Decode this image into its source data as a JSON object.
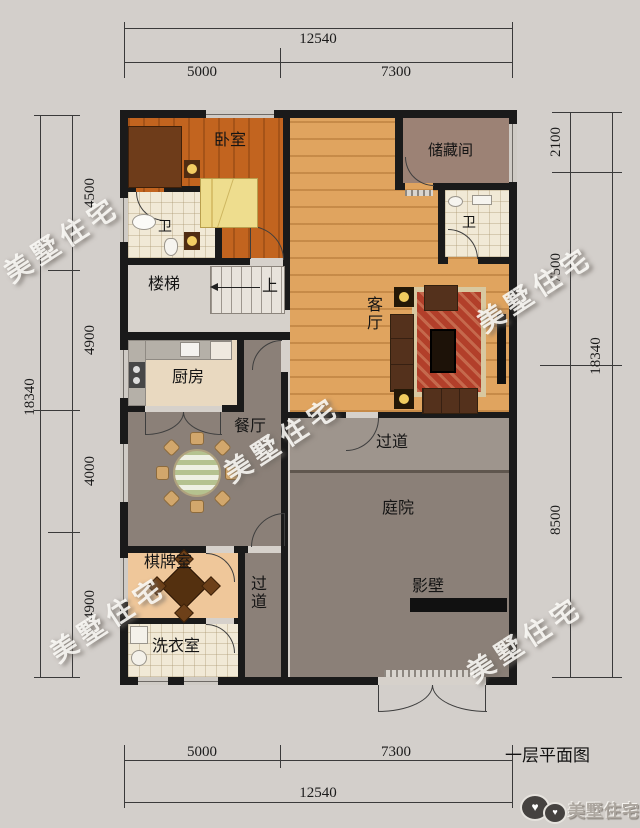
{
  "plan": {
    "title": "一层平面图",
    "watermark": "美墅住宅",
    "logo_text": "美墅住宅",
    "rooms": {
      "bedroom": "卧室",
      "storage": "储藏间",
      "bath1": "卫",
      "bath2": "卫",
      "stairs": "楼梯",
      "stairs_up": "上",
      "living": "客厅",
      "kitchen": "厨房",
      "dining": "餐厅",
      "corridor_v": "过道",
      "corridor_h": "过道",
      "courtyard": "庭院",
      "screen_wall": "影壁",
      "chess": "棋牌室",
      "laundry": "洗衣室"
    },
    "dims": {
      "top": {
        "total": "12540",
        "segments": [
          "5000",
          "7300"
        ]
      },
      "bottom": {
        "total": "12540",
        "segments": [
          "5000",
          "7300"
        ]
      },
      "left": {
        "total": "18340",
        "segments": [
          "4500",
          "4900",
          "4000",
          "4900"
        ]
      },
      "right": {
        "total": "18340",
        "segments": [
          "2100",
          "7500",
          "8500"
        ]
      }
    },
    "colors": {
      "page_bg": "#d3cfcb",
      "wall": "#1a1a1a",
      "bedroom_floor": "#c2641f",
      "living_floor": "#e0a45f",
      "courtyard_floor": "#8b8078",
      "chess_floor": "#efc79a",
      "storage_floor": "#9c8275",
      "rug": "#b23f2a",
      "bed": "#eedd8e"
    }
  }
}
